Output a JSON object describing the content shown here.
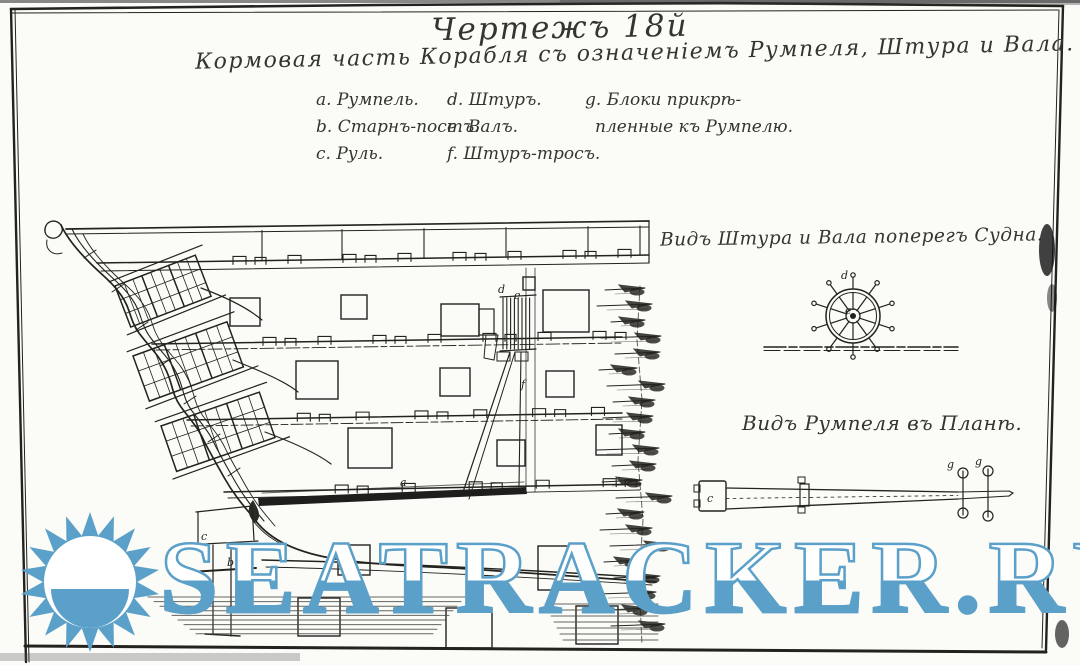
{
  "title": "Чертежъ 18й",
  "subtitle": "Кормовая часть Корабля съ означеніемъ Румпеля, Штура и Вала.",
  "legend": {
    "columns": [
      [
        "a. Румпель.",
        "b. Старнъ-постъ.",
        "c. Руль."
      ],
      [
        "d. Штуръ.",
        "e. Валъ.",
        "f. Штуръ-тросъ."
      ],
      [
        "g. Блоки прикрѣ-",
        "пленные къ Румпелю."
      ]
    ]
  },
  "views": {
    "wheel_caption": "Видъ Штура и Вала поперегъ Судна.",
    "tiller_caption": "Видъ Румпеля въ Планѣ."
  },
  "annotations": {
    "a": "a",
    "b": "b",
    "c": "c",
    "d": "d",
    "e": "e",
    "f": "f",
    "g": "g"
  },
  "watermark": {
    "text": "SEATRACKER.RU",
    "color": "#5ba0c9",
    "logo": "sun-logo"
  },
  "colors": {
    "ink": "#23221e",
    "paper": "#fbfbf8",
    "watermark_blue": "#5ba0c9"
  }
}
